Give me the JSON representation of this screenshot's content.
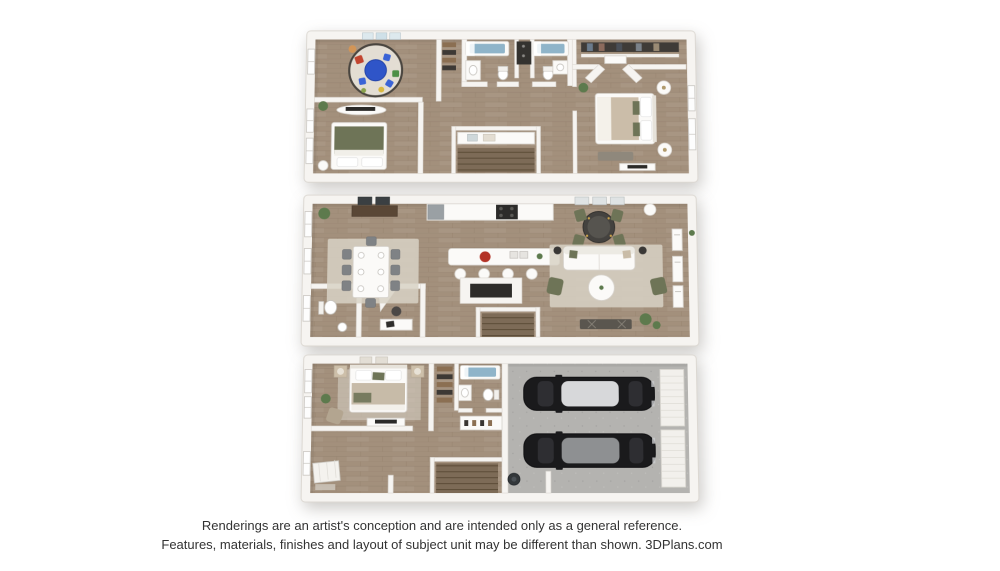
{
  "disclaimer": {
    "line1": "Renderings are an artist's conception and are intended only as a general reference.",
    "line2": "Features, materials, finishes and layout of subject unit may be different than shown. 3DPlans.com"
  },
  "floor_plans": {
    "upper": {
      "features": [
        "kids-playroom",
        "bedroom",
        "hall-bathroom",
        "laundry-closet",
        "second-bathroom",
        "stairs",
        "primary-bedroom",
        "walk-in-closet"
      ]
    },
    "main": {
      "features": [
        "dining-area",
        "kitchen",
        "island-with-stools",
        "game-table",
        "living-room",
        "powder-room",
        "desk-nook",
        "fireplace",
        "stairs"
      ]
    },
    "ground": {
      "features": [
        "bedroom",
        "closet",
        "bathroom",
        "entry",
        "stairs",
        "two-car-garage",
        "garage-doors"
      ]
    }
  },
  "colors": {
    "background": "#ffffff",
    "wall": "#f6f4f1",
    "wall-edge": "#dcd8d2",
    "wood": "#a3907c",
    "wood-line": "#8a7763",
    "wood-dark": "#7d6b57",
    "garage-floor": "#b4b3b0",
    "rug": "#d8d2c6",
    "water": "#8fb4c9",
    "olive": "#6e7457",
    "accent-blue": "#2f55c8",
    "accent-red": "#b33226",
    "car-body": "#1a1a1c",
    "car-roof-light": "#d7d8da",
    "car-roof-gray": "#8e9092",
    "text": "#333333"
  }
}
